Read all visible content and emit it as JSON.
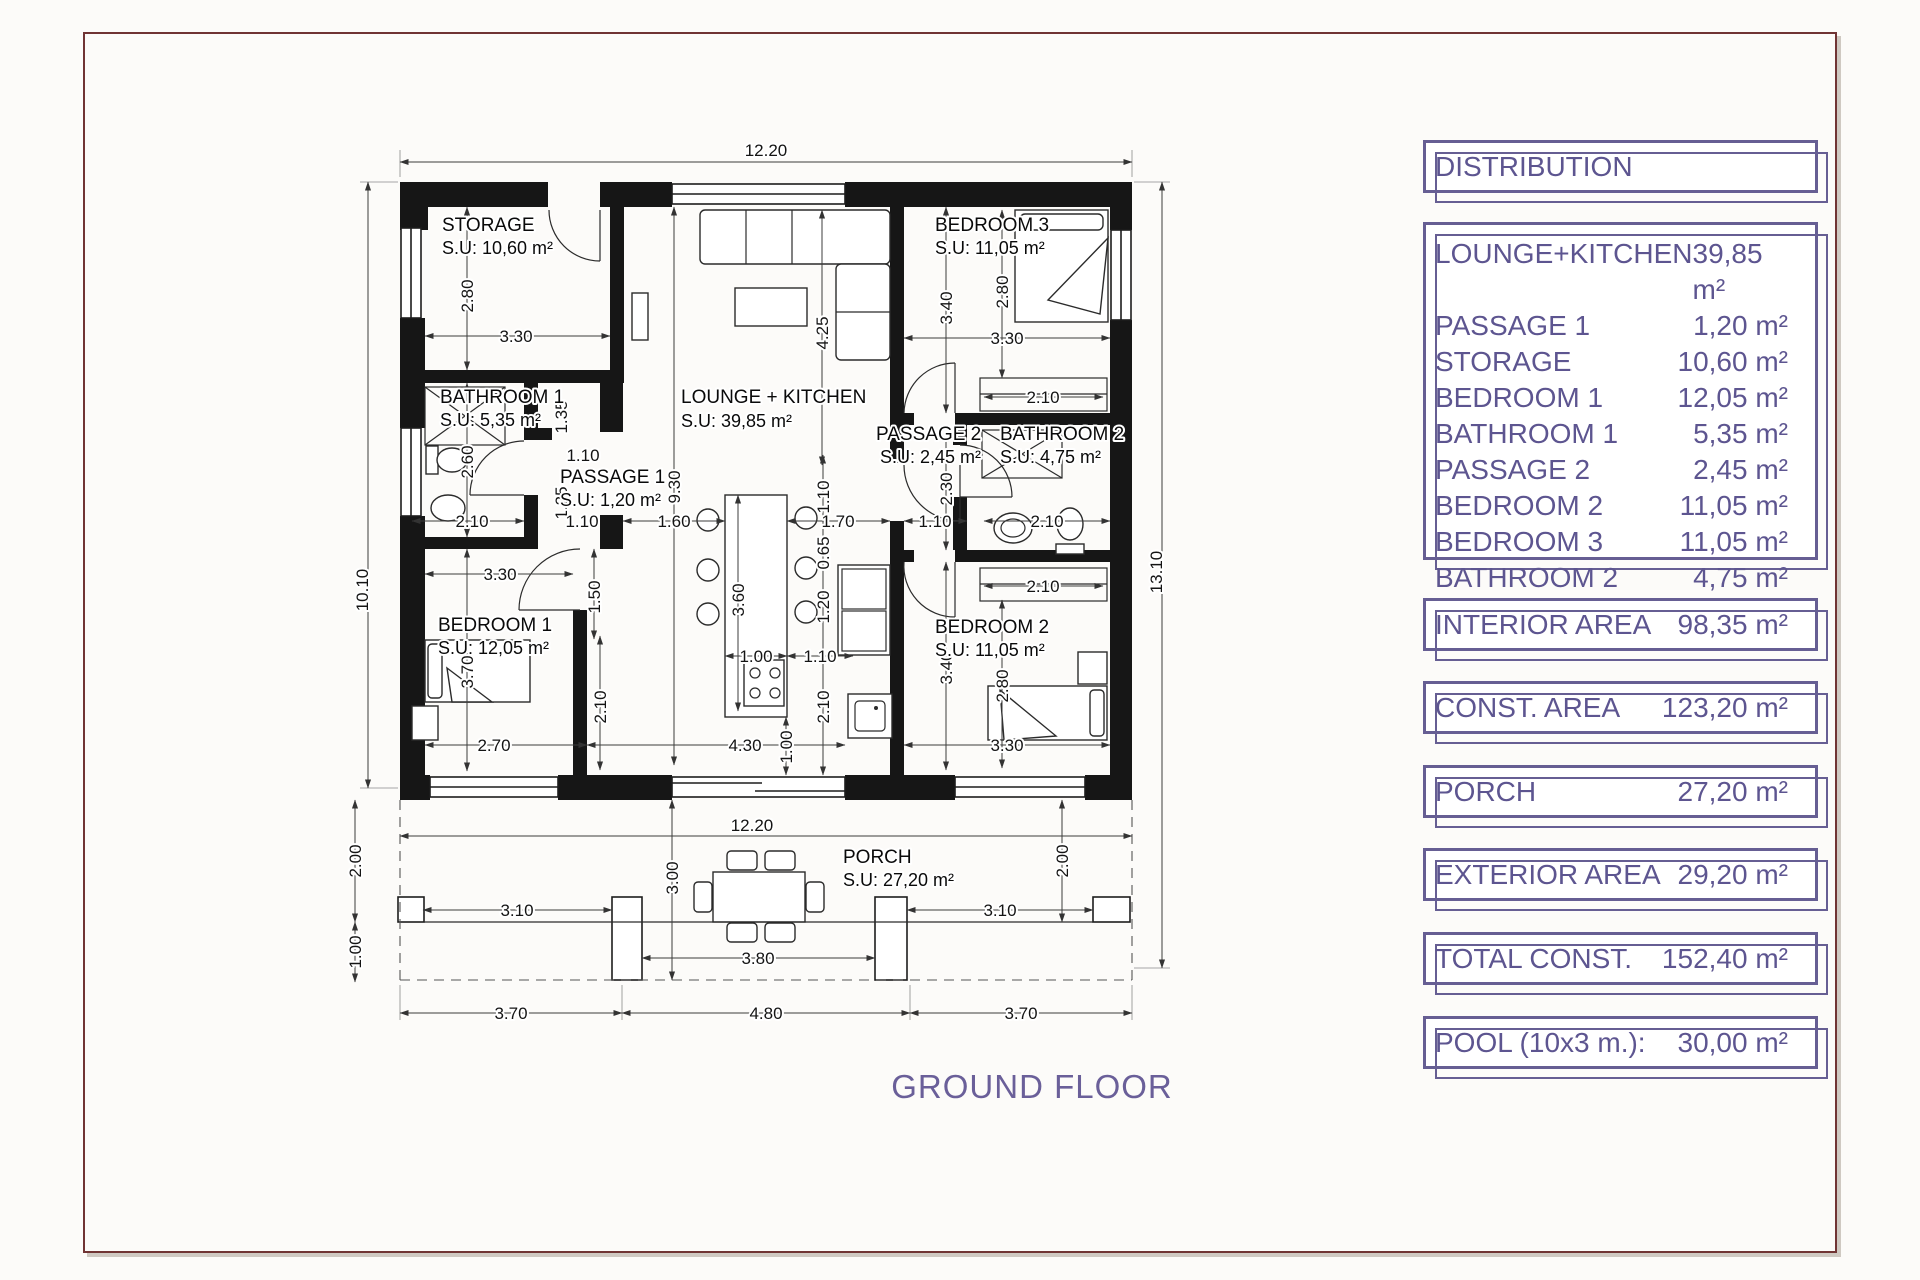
{
  "sheet": {
    "ground_floor_label": "GROUND FLOOR"
  },
  "panel": {
    "title": "DISTRIBUTION",
    "rooms": [
      {
        "label": "LOUNGE+KITCHEN",
        "value": "39,85 m²"
      },
      {
        "label": "PASSAGE 1",
        "value": "1,20 m²"
      },
      {
        "label": "STORAGE",
        "value": "10,60 m²"
      },
      {
        "label": "BEDROOM 1",
        "value": "12,05 m²"
      },
      {
        "label": "BATHROOM 1",
        "value": "5,35 m²"
      },
      {
        "label": "PASSAGE 2",
        "value": "2,45 m²"
      },
      {
        "label": "BEDROOM 2",
        "value": "11,05 m²"
      },
      {
        "label": "BEDROOM 3",
        "value": "11,05 m²"
      },
      {
        "label": "BATHROOM 2",
        "value": "4,75 m²"
      }
    ],
    "summaries": [
      {
        "label": "INTERIOR AREA",
        "value": "98,35 m²"
      },
      {
        "label": "CONST. AREA",
        "value": "123,20 m²"
      },
      {
        "label": "PORCH",
        "value": "27,20 m²"
      },
      {
        "label": "EXTERIOR AREA",
        "value": "29,20 m²"
      },
      {
        "label": "TOTAL CONST.",
        "value": "152,40 m²"
      },
      {
        "label": "POOL (10x3 m.):",
        "value": "30,00 m²"
      }
    ]
  },
  "plan": {
    "rooms": [
      {
        "name": "STORAGE",
        "su": "S.U: 10,60 m²"
      },
      {
        "name": "LOUNGE + KITCHEN",
        "su": "S.U: 39,85 m²"
      },
      {
        "name": "BEDROOM 3",
        "su": "S.U: 11,05 m²"
      },
      {
        "name": "BATHROOM 1",
        "su": "S.U: 5,35 m²"
      },
      {
        "name": "PASSAGE 1",
        "su": "S.U: 1,20 m²"
      },
      {
        "name": "PASSAGE 2",
        "su": "S.U: 2,45 m²"
      },
      {
        "name": "BATHROOM 2",
        "su": "S.U: 4,75 m²"
      },
      {
        "name": "BEDROOM 1",
        "su": "S.U: 12,05 m²"
      },
      {
        "name": "BEDROOM 2",
        "su": "S.U: 11,05 m²"
      },
      {
        "name": "PORCH",
        "su": "S.U: 27,20 m²"
      }
    ],
    "dims": {
      "top_total": "12.20",
      "left_height": "10.10",
      "right_height": "13.10",
      "storage_w": "3.30",
      "storage_h": "2.80",
      "bed3_h": "3.40",
      "bed3_bed": "2.80",
      "bed3_w": "3.30",
      "bed3_closet": "2.10",
      "bath1_h": "2.60",
      "bath1_w": "2.10",
      "pass1_135": "1.35",
      "pass1_110a": "1.10",
      "pass1_125": "1.25",
      "pass1_110b": "1.10",
      "pass1_160": "1.60",
      "lounge_h": "9.30",
      "lounge_425": "4.25",
      "bed1_w": "3.30",
      "bed1_150": "1.50",
      "bed1_h": "3.70",
      "bed1_270": "2.70",
      "bed1_210": "2.10",
      "isl_h": "3.60",
      "isl_w": "1.00",
      "isl_gap": "1.10",
      "k_430": "4.30",
      "k_100": "1.00",
      "k_110v": "1.10",
      "k_065": "0.65",
      "k_120": "1.20",
      "k_210": "2.10",
      "k_170": "1.70",
      "pass2_230": "2.30",
      "pass2_110": "1.10",
      "bath2_w": "2.10",
      "bed2_closet": "2.10",
      "bed2_h": "3.40",
      "bed2_bed": "2.80",
      "bed2_w": "3.30",
      "porch_w": "12.20",
      "porch_d": "3.00",
      "porch_200l": "2.00",
      "porch_100": "1.00",
      "porch_200r": "2.00",
      "porch_310l": "3.10",
      "porch_310r": "3.10",
      "porch_380": "3.80",
      "bot_left": "3.70",
      "bot_mid": "4.80",
      "bot_right": "3.70"
    }
  }
}
